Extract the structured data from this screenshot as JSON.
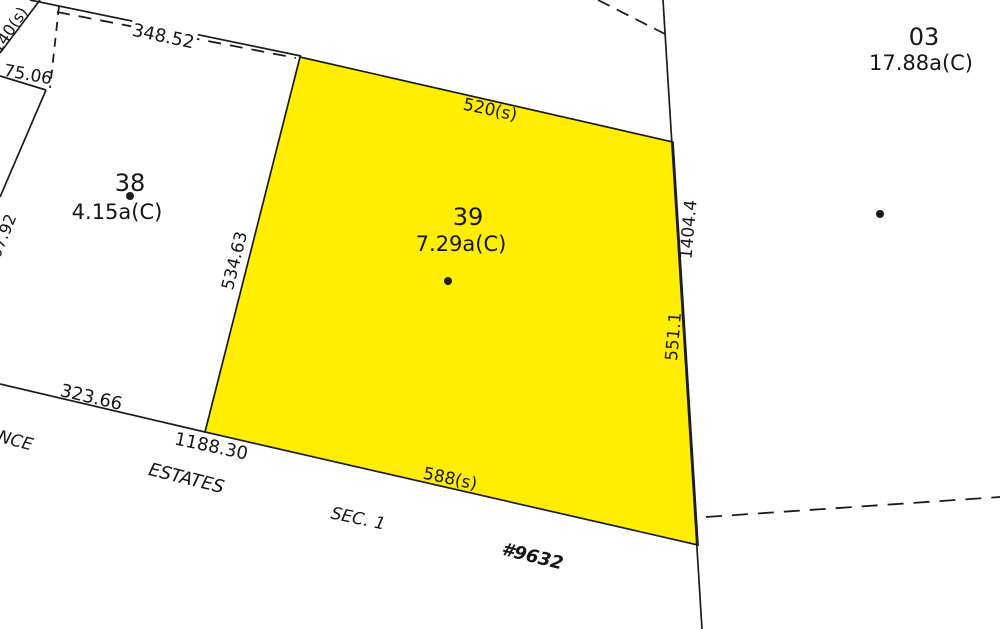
{
  "map": {
    "background": "#ffffff",
    "line_color": "#1c1c1c",
    "highlight_color": "#ffee00",
    "text_color": "#161616",
    "highlighted_parcel_number": "39",
    "highlighted_parcel_points": [
      [
        300,
        57
      ],
      [
        673,
        142
      ],
      [
        698,
        545
      ],
      [
        205,
        432
      ]
    ],
    "parcels": [
      {
        "number": "38",
        "area": "4.15a(C)",
        "nx": 130,
        "ny": 191,
        "ax": 117,
        "ay": 219,
        "dotx": 130,
        "doty": 196,
        "highlighted": false
      },
      {
        "number": "39",
        "area": "7.29a(C)",
        "nx": 468,
        "ny": 225,
        "ax": 461,
        "ay": 251,
        "dotx": 448,
        "doty": 281,
        "highlighted": true
      },
      {
        "number": "03",
        "area": "17.88a(C)",
        "nx": 924,
        "ny": 45,
        "ax": 921,
        "ay": 70,
        "dotx": 880,
        "doty": 214,
        "highlighted": false
      }
    ],
    "solid_lines": [
      {
        "x1": 0,
        "y1": 53,
        "x2": 40,
        "y2": 0
      },
      {
        "x1": 30,
        "y1": 0,
        "x2": 301,
        "y2": 56
      },
      {
        "x1": 0,
        "y1": 76,
        "x2": 46,
        "y2": 90
      },
      {
        "x1": 46,
        "y1": 90,
        "x2": 0,
        "y2": 197
      },
      {
        "x1": 0,
        "y1": 384,
        "x2": 205,
        "y2": 432
      },
      {
        "x1": 663,
        "y1": 0,
        "x2": 702,
        "y2": 629
      }
    ],
    "dashed_lines": [
      {
        "x1": 57,
        "y1": 12,
        "x2": 296,
        "y2": 58,
        "dash": "13 9"
      },
      {
        "x1": 59,
        "y1": 6,
        "x2": 50,
        "y2": 88,
        "dash": "9 7"
      },
      {
        "x1": 598,
        "y1": 0,
        "x2": 665,
        "y2": 34,
        "dash": "13 8"
      },
      {
        "x1": 706,
        "y1": 517,
        "x2": 1000,
        "y2": 497,
        "dash": "16 10"
      }
    ],
    "measurements": [
      {
        "text": "348.52",
        "x": 162,
        "y": 42,
        "rot": 12,
        "size": 18,
        "bg": true
      },
      {
        "text": "75.06",
        "x": 27,
        "y": 80,
        "rot": 10,
        "size": 17
      },
      {
        "text": "140(s)",
        "x": 14,
        "y": 33,
        "rot": -56,
        "size": 16
      },
      {
        "text": "07.92",
        "x": 8,
        "y": 238,
        "rot": -68,
        "size": 16
      },
      {
        "text": "323.66",
        "x": 90,
        "y": 403,
        "rot": 13,
        "size": 18
      },
      {
        "text": "1188.30",
        "x": 210,
        "y": 452,
        "rot": 12,
        "size": 18
      },
      {
        "text": "520(s)",
        "x": 489,
        "y": 115,
        "rot": 12,
        "size": 17
      },
      {
        "text": "534.63",
        "x": 240,
        "y": 262,
        "rot": -76,
        "size": 17
      },
      {
        "text": "1404.4",
        "x": 694,
        "y": 230,
        "rot": -85,
        "size": 17
      },
      {
        "text": "551.1",
        "x": 679,
        "y": 337,
        "rot": -85,
        "size": 17
      },
      {
        "text": "588(s)",
        "x": 449,
        "y": 484,
        "rot": 12,
        "size": 17
      }
    ],
    "annotations": [
      {
        "text": "NCE",
        "x": 14,
        "y": 446,
        "rot": 15,
        "size": 17,
        "bold": false
      },
      {
        "text": "ESTATES",
        "x": 185,
        "y": 484,
        "rot": 14,
        "size": 18,
        "bold": false
      },
      {
        "text": "SEC. 1",
        "x": 357,
        "y": 524,
        "rot": 12,
        "size": 17,
        "bold": false
      },
      {
        "text": "#9632",
        "x": 531,
        "y": 562,
        "rot": 14,
        "size": 18,
        "bold": true
      }
    ]
  }
}
